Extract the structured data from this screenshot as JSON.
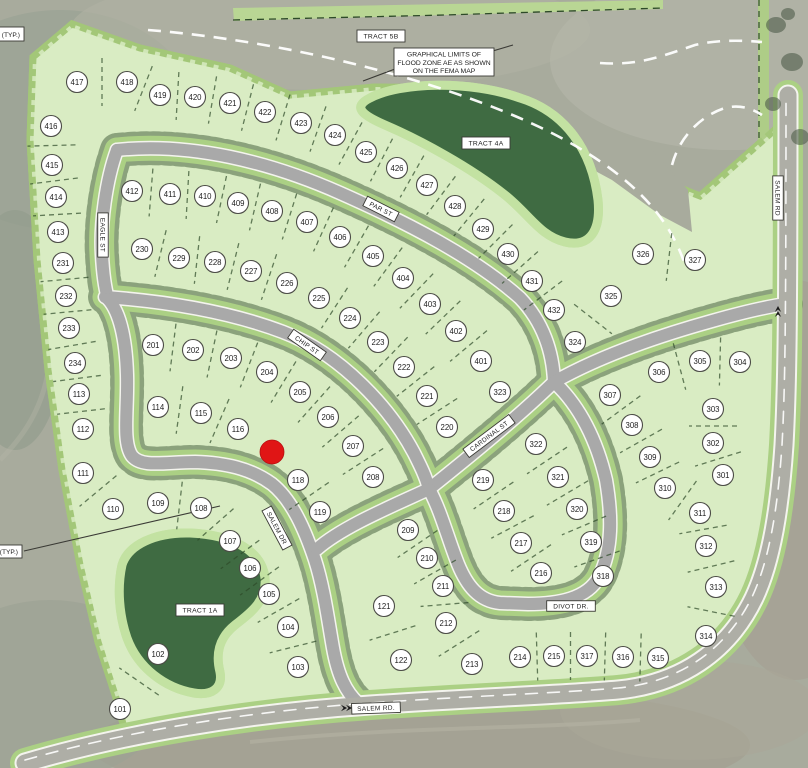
{
  "map": {
    "title": "subdivision-plat-map",
    "marker": {
      "x": 272,
      "y": 452,
      "r": 12,
      "color": "#e01515"
    },
    "colors": {
      "lot_green": "#d9ecc3",
      "buffer_green": "#a3c778",
      "tract_green": "#3f6b42",
      "road_gray": "#a9a9a9",
      "road_casing": "#f4f4ee",
      "aerial_gray": "#a8ab9d",
      "marker_red": "#e01515",
      "dash_green": "#2d4a28"
    },
    "streets": [
      {
        "name": "EAGLE ST",
        "x": 103,
        "y": 235,
        "rot": 90
      },
      {
        "name": "PAR ST",
        "x": 381,
        "y": 209,
        "rot": 27
      },
      {
        "name": "CHIP ST",
        "x": 307,
        "y": 345,
        "rot": 35
      },
      {
        "name": "CARDINAL ST",
        "x": 489,
        "y": 436,
        "rot": -37
      },
      {
        "name": "SALEM DR",
        "x": 277,
        "y": 528,
        "rot": 62
      },
      {
        "name": "DIVOT DR.",
        "x": 571,
        "y": 606,
        "rot": 0
      },
      {
        "name": "SALEM RD.",
        "x": 376,
        "y": 708,
        "rot": -2
      },
      {
        "name": "SALEM RD",
        "x": 778,
        "y": 198,
        "rot": 90
      }
    ],
    "tracts": [
      {
        "name": "TRACT 5B",
        "x": 381,
        "y": 36
      },
      {
        "name": "TRACT 4A",
        "x": 486,
        "y": 143
      },
      {
        "name": "TRACT 1A",
        "x": 200,
        "y": 610
      }
    ],
    "annotations": {
      "flood_note": {
        "lines": [
          "GRAPHICAL LIMITS OF",
          "FLOOD ZONE AE AS SHOWN",
          "ON THE FEMA MAP"
        ],
        "x": 444,
        "y": 62
      },
      "typ_top": {
        "text": "Y (TYP.)",
        "x": 20,
        "y": 37
      },
      "typ_left": {
        "text": "(TYP.)",
        "x": 18,
        "y": 556
      }
    },
    "lots": [
      {
        "n": "101",
        "x": 120,
        "y": 709
      },
      {
        "n": "102",
        "x": 158,
        "y": 654
      },
      {
        "n": "103",
        "x": 298,
        "y": 667
      },
      {
        "n": "104",
        "x": 288,
        "y": 627
      },
      {
        "n": "105",
        "x": 269,
        "y": 594
      },
      {
        "n": "106",
        "x": 250,
        "y": 568
      },
      {
        "n": "107",
        "x": 230,
        "y": 541
      },
      {
        "n": "108",
        "x": 201,
        "y": 508
      },
      {
        "n": "109",
        "x": 158,
        "y": 503
      },
      {
        "n": "110",
        "x": 113,
        "y": 509
      },
      {
        "n": "111",
        "x": 83,
        "y": 473
      },
      {
        "n": "112",
        "x": 83,
        "y": 429
      },
      {
        "n": "113",
        "x": 79,
        "y": 394
      },
      {
        "n": "114",
        "x": 158,
        "y": 407
      },
      {
        "n": "115",
        "x": 201,
        "y": 413
      },
      {
        "n": "116",
        "x": 238,
        "y": 429
      },
      {
        "n": "118",
        "x": 298,
        "y": 480
      },
      {
        "n": "119",
        "x": 320,
        "y": 512
      },
      {
        "n": "121",
        "x": 384,
        "y": 606
      },
      {
        "n": "122",
        "x": 401,
        "y": 660
      },
      {
        "n": "201",
        "x": 153,
        "y": 345
      },
      {
        "n": "202",
        "x": 193,
        "y": 350
      },
      {
        "n": "203",
        "x": 231,
        "y": 358
      },
      {
        "n": "204",
        "x": 267,
        "y": 372
      },
      {
        "n": "205",
        "x": 300,
        "y": 392
      },
      {
        "n": "206",
        "x": 328,
        "y": 417
      },
      {
        "n": "207",
        "x": 353,
        "y": 446
      },
      {
        "n": "208",
        "x": 373,
        "y": 477
      },
      {
        "n": "209",
        "x": 408,
        "y": 530
      },
      {
        "n": "210",
        "x": 427,
        "y": 558
      },
      {
        "n": "211",
        "x": 443,
        "y": 586
      },
      {
        "n": "212",
        "x": 446,
        "y": 623
      },
      {
        "n": "213",
        "x": 472,
        "y": 664
      },
      {
        "n": "214",
        "x": 520,
        "y": 657
      },
      {
        "n": "215",
        "x": 554,
        "y": 656
      },
      {
        "n": "216",
        "x": 541,
        "y": 573
      },
      {
        "n": "217",
        "x": 521,
        "y": 543
      },
      {
        "n": "218",
        "x": 504,
        "y": 511
      },
      {
        "n": "219",
        "x": 483,
        "y": 480
      },
      {
        "n": "220",
        "x": 447,
        "y": 427
      },
      {
        "n": "221",
        "x": 427,
        "y": 396
      },
      {
        "n": "222",
        "x": 404,
        "y": 367
      },
      {
        "n": "223",
        "x": 378,
        "y": 342
      },
      {
        "n": "224",
        "x": 350,
        "y": 318
      },
      {
        "n": "225",
        "x": 319,
        "y": 298
      },
      {
        "n": "226",
        "x": 287,
        "y": 283
      },
      {
        "n": "227",
        "x": 251,
        "y": 271
      },
      {
        "n": "228",
        "x": 215,
        "y": 262
      },
      {
        "n": "229",
        "x": 179,
        "y": 258
      },
      {
        "n": "230",
        "x": 142,
        "y": 249
      },
      {
        "n": "231",
        "x": 63,
        "y": 263
      },
      {
        "n": "232",
        "x": 66,
        "y": 296
      },
      {
        "n": "233",
        "x": 69,
        "y": 328
      },
      {
        "n": "234",
        "x": 75,
        "y": 363
      },
      {
        "n": "301",
        "x": 723,
        "y": 475
      },
      {
        "n": "302",
        "x": 713,
        "y": 443
      },
      {
        "n": "303",
        "x": 713,
        "y": 409
      },
      {
        "n": "304",
        "x": 740,
        "y": 362
      },
      {
        "n": "305",
        "x": 700,
        "y": 361
      },
      {
        "n": "306",
        "x": 659,
        "y": 372
      },
      {
        "n": "307",
        "x": 610,
        "y": 395
      },
      {
        "n": "308",
        "x": 632,
        "y": 425
      },
      {
        "n": "309",
        "x": 650,
        "y": 457
      },
      {
        "n": "310",
        "x": 665,
        "y": 488
      },
      {
        "n": "311",
        "x": 700,
        "y": 513
      },
      {
        "n": "312",
        "x": 706,
        "y": 546
      },
      {
        "n": "313",
        "x": 716,
        "y": 587
      },
      {
        "n": "314",
        "x": 706,
        "y": 636
      },
      {
        "n": "315",
        "x": 658,
        "y": 658
      },
      {
        "n": "316",
        "x": 623,
        "y": 657
      },
      {
        "n": "317",
        "x": 587,
        "y": 656
      },
      {
        "n": "318",
        "x": 603,
        "y": 576
      },
      {
        "n": "319",
        "x": 591,
        "y": 542
      },
      {
        "n": "320",
        "x": 577,
        "y": 509
      },
      {
        "n": "321",
        "x": 558,
        "y": 477
      },
      {
        "n": "322",
        "x": 536,
        "y": 444
      },
      {
        "n": "323",
        "x": 500,
        "y": 392
      },
      {
        "n": "324",
        "x": 575,
        "y": 342
      },
      {
        "n": "325",
        "x": 611,
        "y": 296
      },
      {
        "n": "326",
        "x": 643,
        "y": 254
      },
      {
        "n": "327",
        "x": 695,
        "y": 260
      },
      {
        "n": "401",
        "x": 481,
        "y": 361
      },
      {
        "n": "402",
        "x": 456,
        "y": 331
      },
      {
        "n": "403",
        "x": 430,
        "y": 304
      },
      {
        "n": "404",
        "x": 403,
        "y": 278
      },
      {
        "n": "405",
        "x": 373,
        "y": 256
      },
      {
        "n": "406",
        "x": 340,
        "y": 237
      },
      {
        "n": "407",
        "x": 307,
        "y": 222
      },
      {
        "n": "408",
        "x": 272,
        "y": 211
      },
      {
        "n": "409",
        "x": 238,
        "y": 203
      },
      {
        "n": "410",
        "x": 205,
        "y": 196
      },
      {
        "n": "411",
        "x": 170,
        "y": 194
      },
      {
        "n": "412",
        "x": 132,
        "y": 191
      },
      {
        "n": "413",
        "x": 58,
        "y": 232
      },
      {
        "n": "414",
        "x": 56,
        "y": 197
      },
      {
        "n": "415",
        "x": 52,
        "y": 165
      },
      {
        "n": "416",
        "x": 51,
        "y": 126
      },
      {
        "n": "417",
        "x": 77,
        "y": 82
      },
      {
        "n": "418",
        "x": 127,
        "y": 82
      },
      {
        "n": "419",
        "x": 160,
        "y": 95
      },
      {
        "n": "420",
        "x": 195,
        "y": 97
      },
      {
        "n": "421",
        "x": 230,
        "y": 103
      },
      {
        "n": "422",
        "x": 265,
        "y": 112
      },
      {
        "n": "423",
        "x": 301,
        "y": 123
      },
      {
        "n": "424",
        "x": 335,
        "y": 135
      },
      {
        "n": "425",
        "x": 366,
        "y": 152
      },
      {
        "n": "426",
        "x": 397,
        "y": 168
      },
      {
        "n": "427",
        "x": 427,
        "y": 185
      },
      {
        "n": "428",
        "x": 455,
        "y": 206
      },
      {
        "n": "429",
        "x": 483,
        "y": 229
      },
      {
        "n": "430",
        "x": 508,
        "y": 254
      },
      {
        "n": "431",
        "x": 532,
        "y": 281
      },
      {
        "n": "432",
        "x": 554,
        "y": 310
      }
    ]
  }
}
